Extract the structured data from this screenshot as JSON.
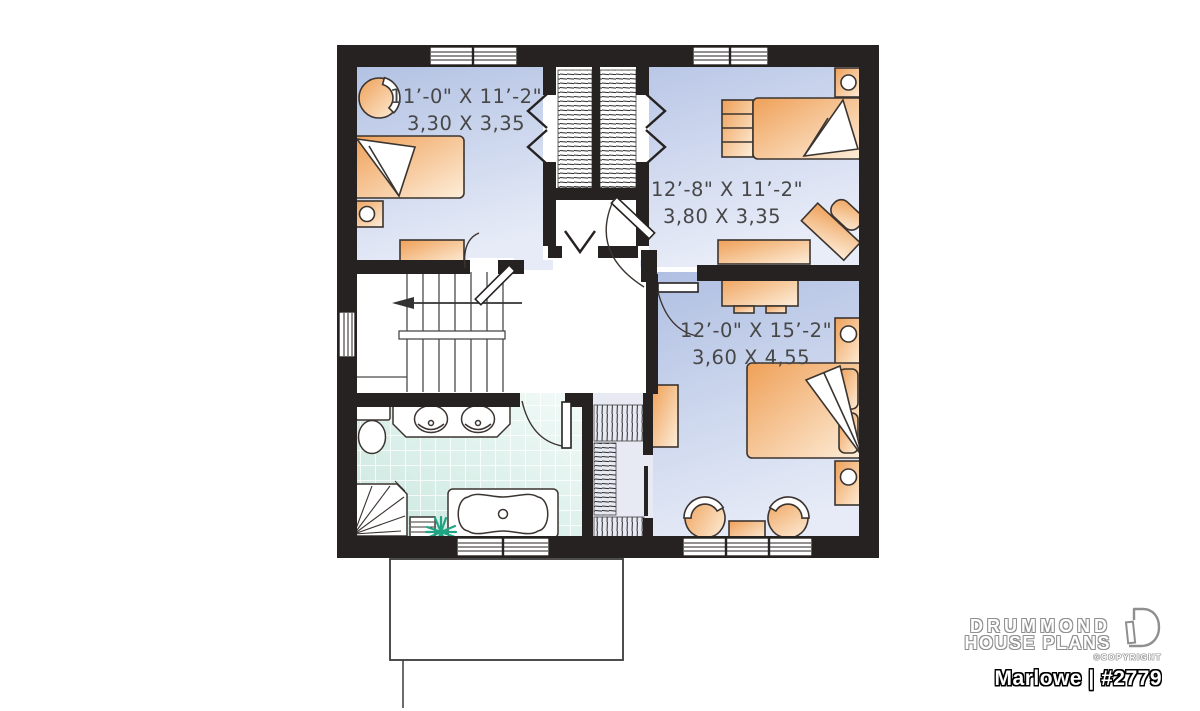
{
  "branding": {
    "line1": "DRUMMOND",
    "line2": "HOUSE PLANS",
    "copyright": "©COPYRIGHT",
    "plan_label": "Marlowe | #2779"
  },
  "rooms": [
    {
      "name": "bedroom-top-left",
      "imperial": "11’-0\" X 11’-2\"",
      "metric": "3,30 X 3,35"
    },
    {
      "name": "bedroom-top-right",
      "imperial": "12’-8\" X 11’-2\"",
      "metric": "3,80 X 3,35"
    },
    {
      "name": "master-bedroom",
      "imperial": "12’-0\" X 15’-2\"",
      "metric": "3,60 X 4,55"
    }
  ],
  "fixtures": [
    "double-closet",
    "linen-closet",
    "staircase-down-arrow",
    "bathroom-double-vanity",
    "toilet",
    "corner-shower",
    "bathtub",
    "bath-step",
    "plant",
    "walk-in-closet",
    "bed",
    "dresser",
    "nightstand-lamp",
    "desk-chair",
    "armchair",
    "side-table",
    "window",
    "door-swing"
  ],
  "colors": {
    "wall": "#262221",
    "room_fill_top": "#afbfe2",
    "room_fill_bottom": "#e6ebf7",
    "walkin_fill": "#e7eaf3",
    "bath_tile": "#cde8e0",
    "furniture_dark": "#efa058",
    "furniture_light": "#fdeeda",
    "plant_green": "#1fa583",
    "dimension_text": "#474747",
    "stair_line": "#4a4a4a"
  }
}
